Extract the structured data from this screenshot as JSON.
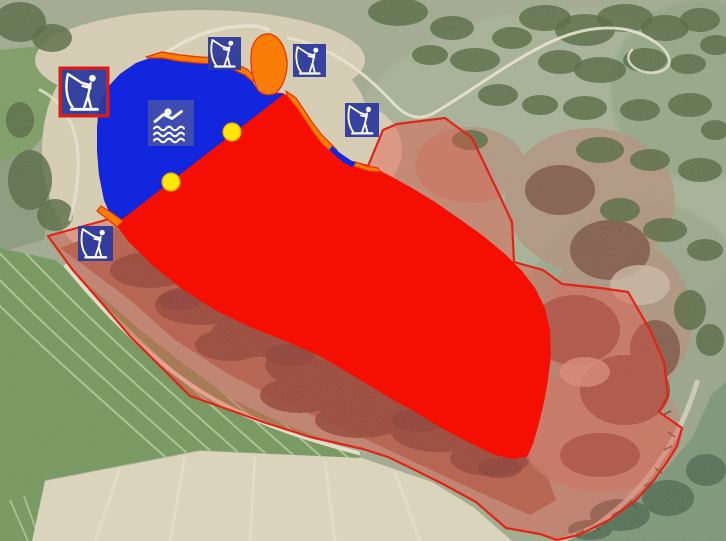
{
  "map": {
    "kind": "aerial-photo-with-zone-overlays",
    "colors": {
      "swim_zone_blue": "#1126dd",
      "closed_zone_red": "#f50f02",
      "bank_strip_orange": "#f87c06",
      "strip_edge_red": "#e23500",
      "protected_area_fill": "rgba(232,82,70,0.42)",
      "protected_area_stroke": "#e02517",
      "icon_bg_blue": "#2c3a9e",
      "swim_icon_bg": "#4351ac",
      "icon_glyph_white": "#ffffff",
      "icon_highlight_border": "#cf1f1f",
      "buoy_yellow": "#ffe707",
      "buoy_edge": "#e8a300"
    },
    "icon_names": {
      "angler": "angler-icon",
      "swimmer": "swimmer-icon",
      "buoy": "buoy-marker"
    },
    "markers": {
      "anglers": [
        {
          "x": 62,
          "y": 70,
          "size": 44,
          "highlighted": true
        },
        {
          "x": 208,
          "y": 37,
          "size": 33,
          "highlighted": false
        },
        {
          "x": 293,
          "y": 44,
          "size": 33,
          "highlighted": false
        },
        {
          "x": 345,
          "y": 103,
          "size": 34,
          "highlighted": false
        },
        {
          "x": 78,
          "y": 226,
          "size": 35,
          "highlighted": false
        }
      ],
      "swimmer": {
        "x": 148,
        "y": 100,
        "size": 46
      },
      "buoys": [
        {
          "cx": 232,
          "cy": 132,
          "r": 9
        },
        {
          "cx": 171,
          "cy": 182,
          "r": 9
        }
      ]
    }
  }
}
